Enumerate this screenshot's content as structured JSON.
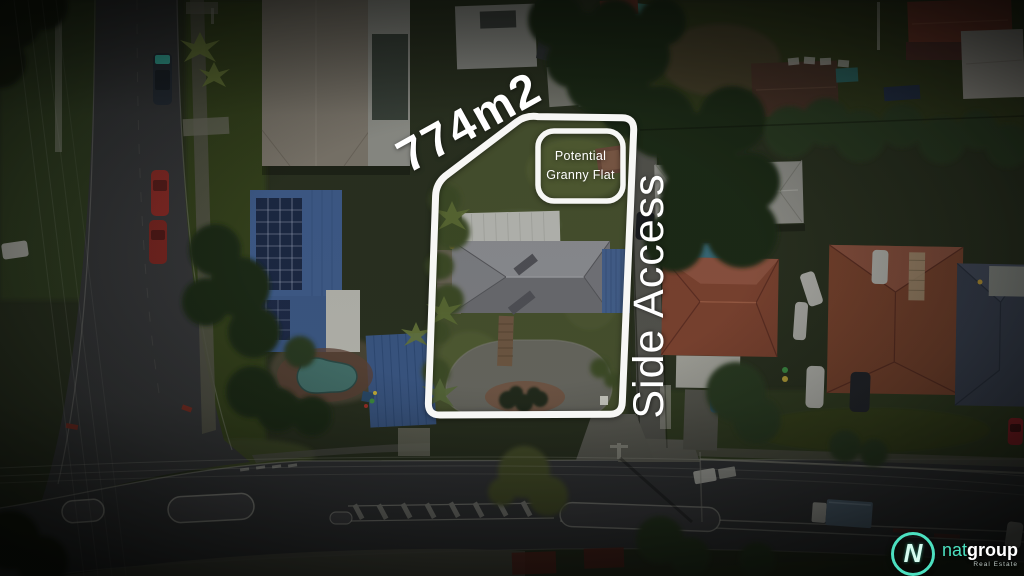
{
  "annotations": {
    "area_label": "774m2",
    "granny_flat": {
      "line1": "Potential",
      "line2": "Granny Flat"
    },
    "side_access_label": "Side Access",
    "outline_color": "#ffffff"
  },
  "logo": {
    "monogram": "N",
    "brand_light": "nat",
    "brand_bold": "group",
    "tagline": "Real Estate",
    "accent_color": "#4ce0c0"
  },
  "scene": {
    "description": "Aerial drone photograph at dusk of a suburban property outlined in white, showing house, circular driveway, granny flat area and side access beside a road intersection",
    "palette": {
      "grass_dark": "#2a3120",
      "lawn": "#46512d",
      "road": "#37383a",
      "concrete": "#63635b",
      "roof_grey": "#7e7f83",
      "roof_blue": "#3f5c8a",
      "roof_terracotta": "#7c4330",
      "roof_white": "#b9bab4",
      "pool_water": "#44706a",
      "tree_dark": "#1f2a18"
    }
  }
}
